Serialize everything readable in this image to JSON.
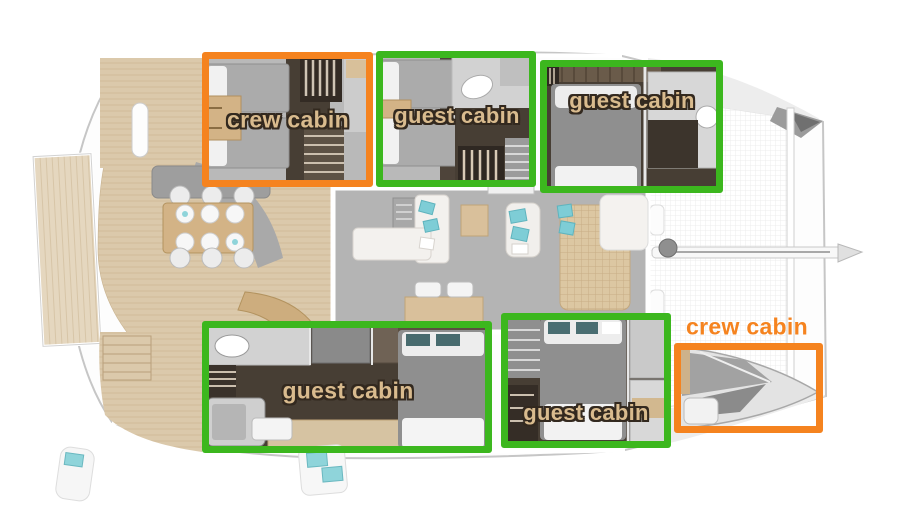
{
  "page": {
    "description": "Top-view catamaran yacht deck plan with cabin annotation overlays"
  },
  "colors": {
    "crew_accent": "#f5831f",
    "guest_accent": "#3cb71e",
    "label_tan": "#d9bb8e",
    "label_outline": "#33291f"
  },
  "annotations": [
    {
      "id": "crew-cabin-port-aft",
      "label": "crew cabin",
      "type": "crew",
      "color": "#f5831f",
      "box": {
        "x": 202,
        "y": 52,
        "w": 171,
        "h": 135
      },
      "label_pos": {
        "x": 288,
        "y": 120
      },
      "label_style": "tan",
      "font_size": 23
    },
    {
      "id": "guest-cabin-port-mid",
      "label": "guest cabin",
      "type": "guest",
      "color": "#3cb71e",
      "box": {
        "x": 376,
        "y": 51,
        "w": 160,
        "h": 136
      },
      "label_pos": {
        "x": 457,
        "y": 116
      },
      "label_style": "tan",
      "font_size": 22
    },
    {
      "id": "guest-cabin-port-fwd",
      "label": "guest cabin",
      "type": "guest",
      "color": "#3cb71e",
      "box": {
        "x": 540,
        "y": 60,
        "w": 183,
        "h": 133
      },
      "label_pos": {
        "x": 632,
        "y": 101
      },
      "label_style": "tan",
      "font_size": 22
    },
    {
      "id": "guest-cabin-stbd-aft",
      "label": "guest cabin",
      "type": "guest",
      "color": "#3cb71e",
      "box": {
        "x": 202,
        "y": 321,
        "w": 290,
        "h": 132
      },
      "label_pos": {
        "x": 348,
        "y": 391
      },
      "label_style": "tan",
      "font_size": 23
    },
    {
      "id": "guest-cabin-stbd-fwd",
      "label": "guest cabin",
      "type": "guest",
      "color": "#3cb71e",
      "box": {
        "x": 501,
        "y": 313,
        "w": 170,
        "h": 135
      },
      "label_pos": {
        "x": 586,
        "y": 413
      },
      "label_style": "tan",
      "font_size": 22
    },
    {
      "id": "crew-cabin-stbd-bow",
      "label": "crew cabin",
      "type": "crew",
      "color": "#f5831f",
      "box": {
        "x": 674,
        "y": 343,
        "w": 149,
        "h": 90
      },
      "label_pos": {
        "x": 747,
        "y": 327
      },
      "label_style": "orange",
      "font_size": 23
    }
  ]
}
